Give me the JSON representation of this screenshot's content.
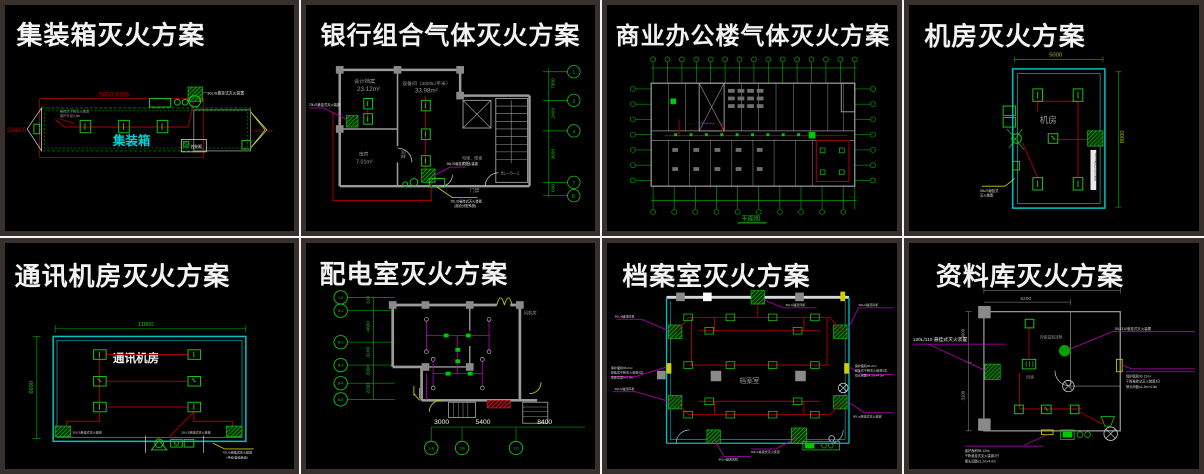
{
  "palette": {
    "background": "#000000",
    "frame": "#37302c",
    "separator": "#f5f5f5",
    "title": "#f2f2f2",
    "cad_green": "#19c819",
    "dim_green": "#00a000",
    "pipe_red": "#9b0000",
    "dim_red": "#c00000",
    "wall_gray": "#9a9a9a",
    "cyan": "#00bfbf",
    "magenta": "#bf00bf",
    "yellow": "#cfcf00"
  },
  "panels": [
    {
      "title": "集装箱灭火方案",
      "room": "集装箱",
      "dim_top": "6860.9386",
      "dim_left": "2348.0",
      "dim_right": "11.9906×2.4380",
      "device_label": "90L/S悬挂式灭火装置",
      "box_label": "控制柜",
      "note_lines": [
        "悬挂式干粉灭火装置",
        "保护半径4.5m"
      ]
    },
    {
      "title": "银行组合气体灭火方案",
      "room1_name": "会计档案",
      "room1_area": "23.12m²",
      "room2_name": "设备间（3000L/平米）",
      "room2_area": "33.98m²",
      "room3_name": "库房",
      "room3_area": "7.01m²",
      "duct": "风管",
      "door": "门禁",
      "lobby1": "电梯、楼梯",
      "lobby2": "前室",
      "stair": "BL—5—1",
      "leader_left": "70L/S悬挂式灭火装置",
      "leader_mid": "90L/S悬挂式灭火装置",
      "bottom_note": [
        "70L/S悬挂式灭火装置",
        "(组合分配系统)"
      ],
      "grid_dims": [
        "7300",
        "2400",
        "3600",
        "600"
      ],
      "bubbles": [
        "1",
        "2",
        "4",
        "7",
        "D"
      ]
    },
    {
      "title": "商业办公楼气体灭火方案",
      "caption": "平面图"
    },
    {
      "title": "机房灭火方案",
      "room": "机房",
      "dim_top": "5000",
      "dim_right": "8000",
      "device_label": "90L/S悬挂式灭火装置",
      "note_lines": [
        "90L/S悬挂式",
        "灭火装置"
      ]
    },
    {
      "title": "通讯机房灭火方案",
      "room": "通讯机房",
      "dim_top": "11800",
      "dim_left": "6600",
      "corner_left": "30L/S悬挂式灭火装置",
      "corner_right": "30L/S悬挂式灭火装置",
      "bottom_note": [
        "70L/S悬挂式灭火装置",
        "(手动/自动启动)"
      ]
    },
    {
      "title": "配电室灭火方案",
      "fan_room": "风机房",
      "left_dims": [
        "310",
        "4600",
        "3100",
        "2000",
        "2200"
      ],
      "bottom_dims": [
        "3000",
        "5400",
        "8400"
      ],
      "left_bubbles": [
        "1-0",
        "B-1",
        "B-2",
        "B-3",
        "B-4",
        "B-5"
      ],
      "bottom_bubbles": [
        "1-A",
        "1-B",
        "1-D"
      ]
    },
    {
      "title": "档案室灭火方案",
      "room": "档案室",
      "fan_label": "90L/s轴流风机",
      "device_label": "90L/s悬挂式灭火装置",
      "left_note": [
        "保护面积96.2m²",
        "悬挂式干粉灭火装置9具",
        "安装高度h=2.8m"
      ],
      "right_note": [
        "保护面积96.2m²",
        "悬挂式干粉灭火装置9具",
        "喷头间距≤4.2m×4.0m"
      ]
    },
    {
      "title": "资料库灭火方案",
      "dim_top": "5200",
      "left_dims": [
        "3000",
        "3100"
      ],
      "label_left": "120L/110 悬挂式灭火装置",
      "label_circle": "内保温泡沫枪",
      "label_right_top": "30L/310悬挂式灭火装置",
      "valve": "风阀",
      "right_note": [
        "保护面积90.12m²",
        "干粉悬挂式灭火装置3只",
        "喷头间距≤1.2m×4.0m"
      ],
      "bottom_note": [
        "保护面积95.12m²",
        "干粉悬挂式灭火装置3只",
        "喷头间距≤1.2m×4.0m"
      ]
    }
  ]
}
